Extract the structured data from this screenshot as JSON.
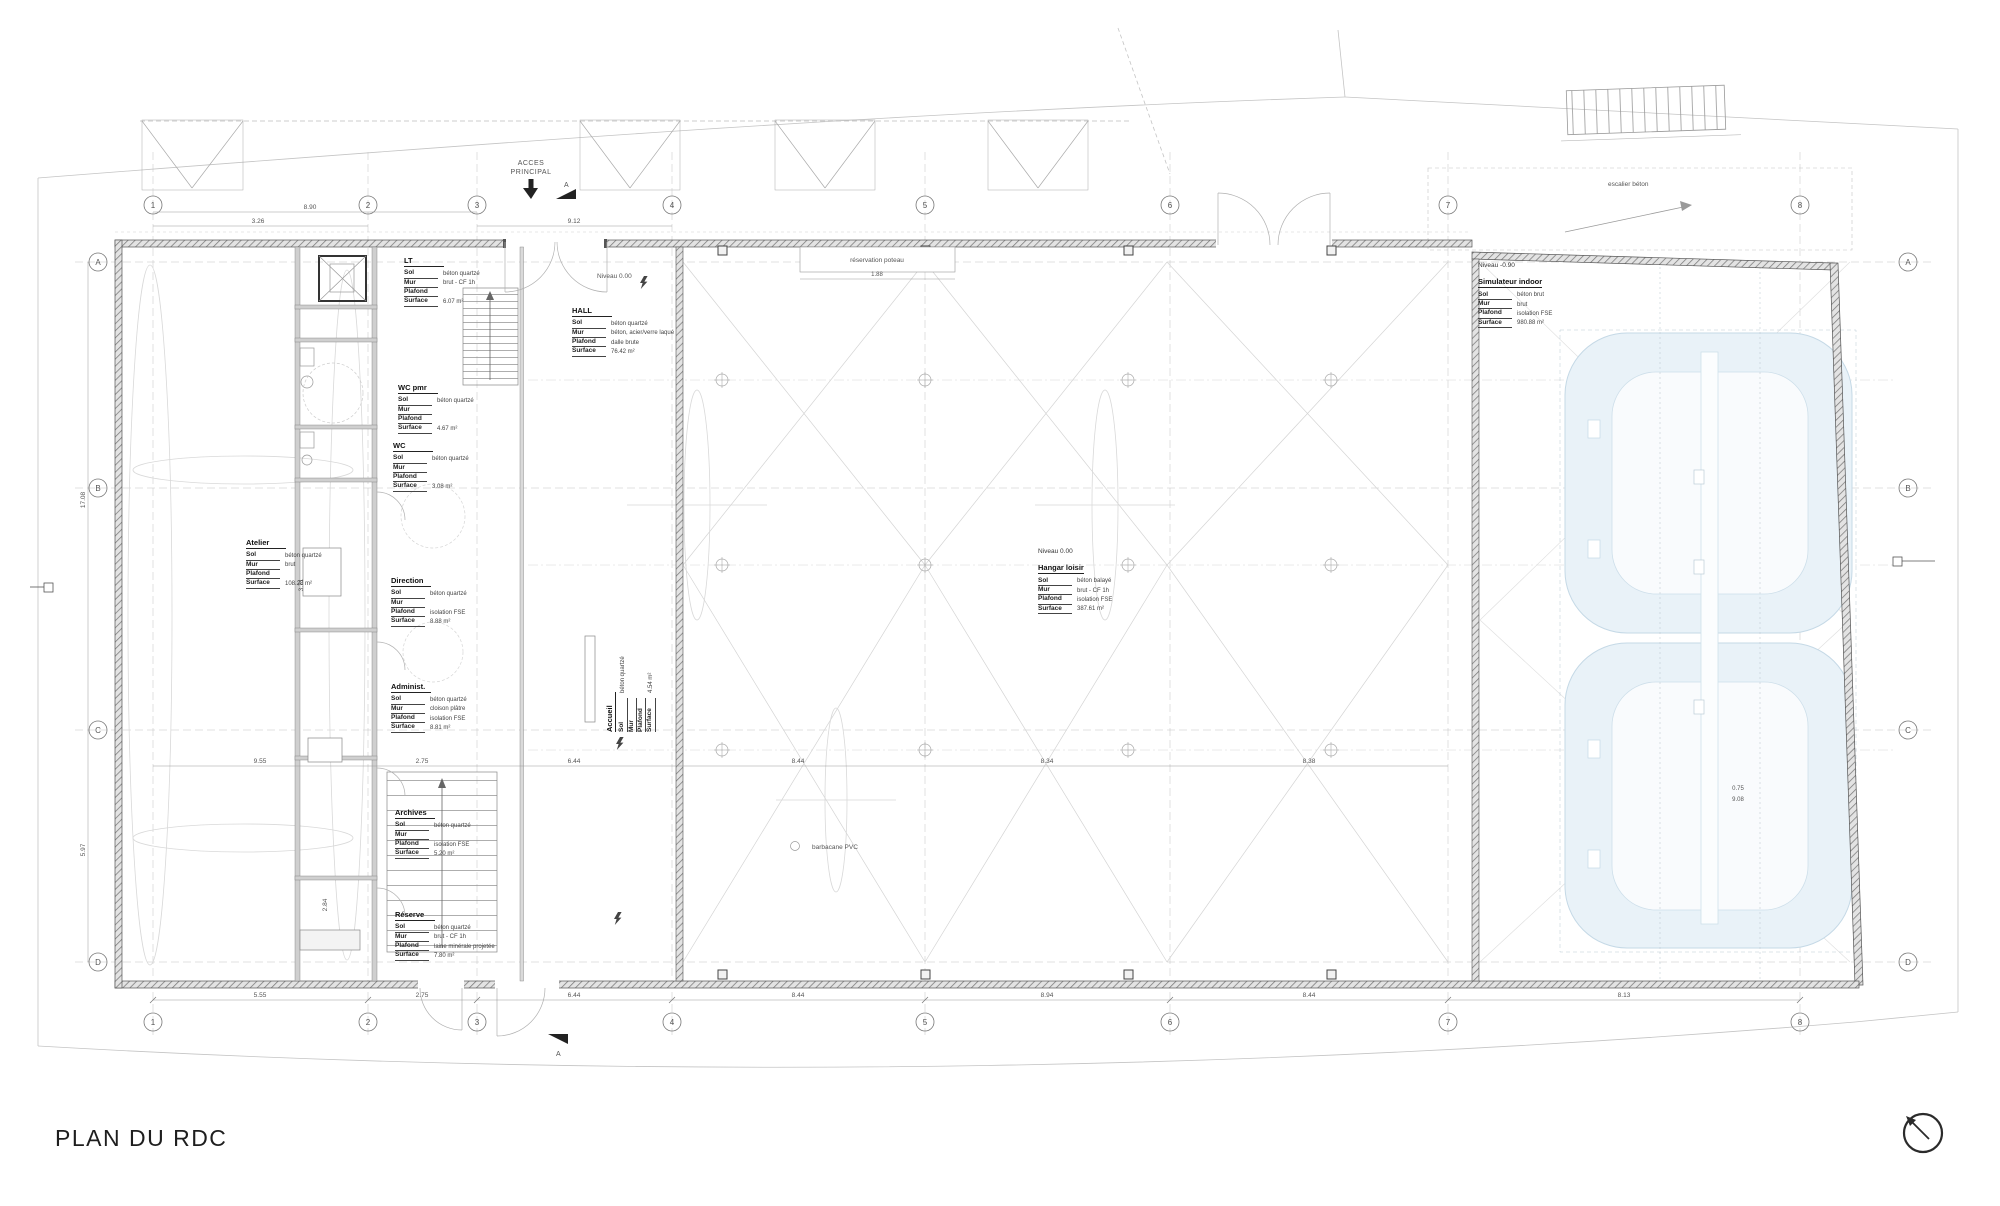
{
  "title": "PLAN DU RDC",
  "labels": {
    "sol": "Sol",
    "mur": "Mur",
    "plafond": "Plafond",
    "surface": "Surface"
  },
  "rooms": [
    {
      "name": "LT",
      "sol": "béton quartzé",
      "mur": "brut - CF 1h",
      "plafond": "",
      "surface": "6.07 m²"
    },
    {
      "name": "HALL",
      "sol": "béton quartzé",
      "mur": "béton, acier/verre laqué",
      "plafond": "dalle brute",
      "surface": "76.42 m²"
    },
    {
      "name": "WC pmr",
      "sol": "béton quartzé",
      "mur": "",
      "plafond": "",
      "surface": "4.67 m²"
    },
    {
      "name": "WC",
      "sol": "béton quartzé",
      "mur": "",
      "plafond": "",
      "surface": "3.08 m²"
    },
    {
      "name": "Atelier",
      "sol": "béton quartzé",
      "mur": "brut",
      "plafond": "",
      "surface": "108.28 m²"
    },
    {
      "name": "Direction",
      "sol": "béton quartzé",
      "mur": "",
      "plafond": "isolation FSE",
      "surface": "8.88 m²"
    },
    {
      "name": "Administ.",
      "sol": "béton quartzé",
      "mur": "cloison plâtre",
      "plafond": "isolation FSE",
      "surface": "8.81 m²"
    },
    {
      "name": "Archives",
      "sol": "béton quartzé",
      "mur": "",
      "plafond": "isolation FSE",
      "surface": "5.20 m²"
    },
    {
      "name": "Réserve",
      "sol": "béton quartzé",
      "mur": "brut - CF 1h",
      "plafond": "laine minérale projetée",
      "surface": "7.80 m²"
    },
    {
      "name": "Accueil",
      "sol": "béton quartzé",
      "mur": "",
      "plafond": "",
      "surface": "4.54 m²"
    },
    {
      "name": "Hangar loisir",
      "niveau": "Niveau 0.00",
      "sol": "béton balayé",
      "mur": "brut - CF 1h",
      "plafond": "isolation FSE",
      "surface": "387.61 m²"
    },
    {
      "name": "Simulateur indoor",
      "niveau": "Niveau -0.90",
      "sol": "béton brut",
      "mur": "brut",
      "plafond": "isolation FSE",
      "surface": "980.88 m²"
    }
  ],
  "grid": {
    "cols": [
      "1",
      "2",
      "3",
      "4",
      "5",
      "6",
      "7",
      "8"
    ],
    "rows": [
      "A",
      "B",
      "C",
      "D"
    ]
  },
  "dims": {
    "t1": "8.90",
    "t2": "3.26",
    "t3": "9.12",
    "res": "1.88",
    "left1": "17.08",
    "left2": "5.97",
    "v1": "3.71",
    "v2": "2.84",
    "s1": "0.75",
    "s2": "9.08",
    "mid": [
      "9.55",
      "2.75",
      "6.44",
      "8.44",
      "8.34",
      "8.38"
    ],
    "bottom": [
      "5.55",
      "2.75",
      "6.44",
      "8.44",
      "8.94",
      "8.44",
      "8.13"
    ]
  },
  "annotations": {
    "acces1": "ACCES",
    "acces2": "PRINCIPAL",
    "section": "A",
    "reservation": "réservation poteau",
    "barbacane": "barbacane PVC",
    "escalier": "escalier béton",
    "niveau_hall": "Niveau 0.00"
  },
  "colors": {
    "pool": "#e9f2f8",
    "pool_stroke": "#c5d9e6",
    "wall": "#555555",
    "accent": "#222222"
  }
}
